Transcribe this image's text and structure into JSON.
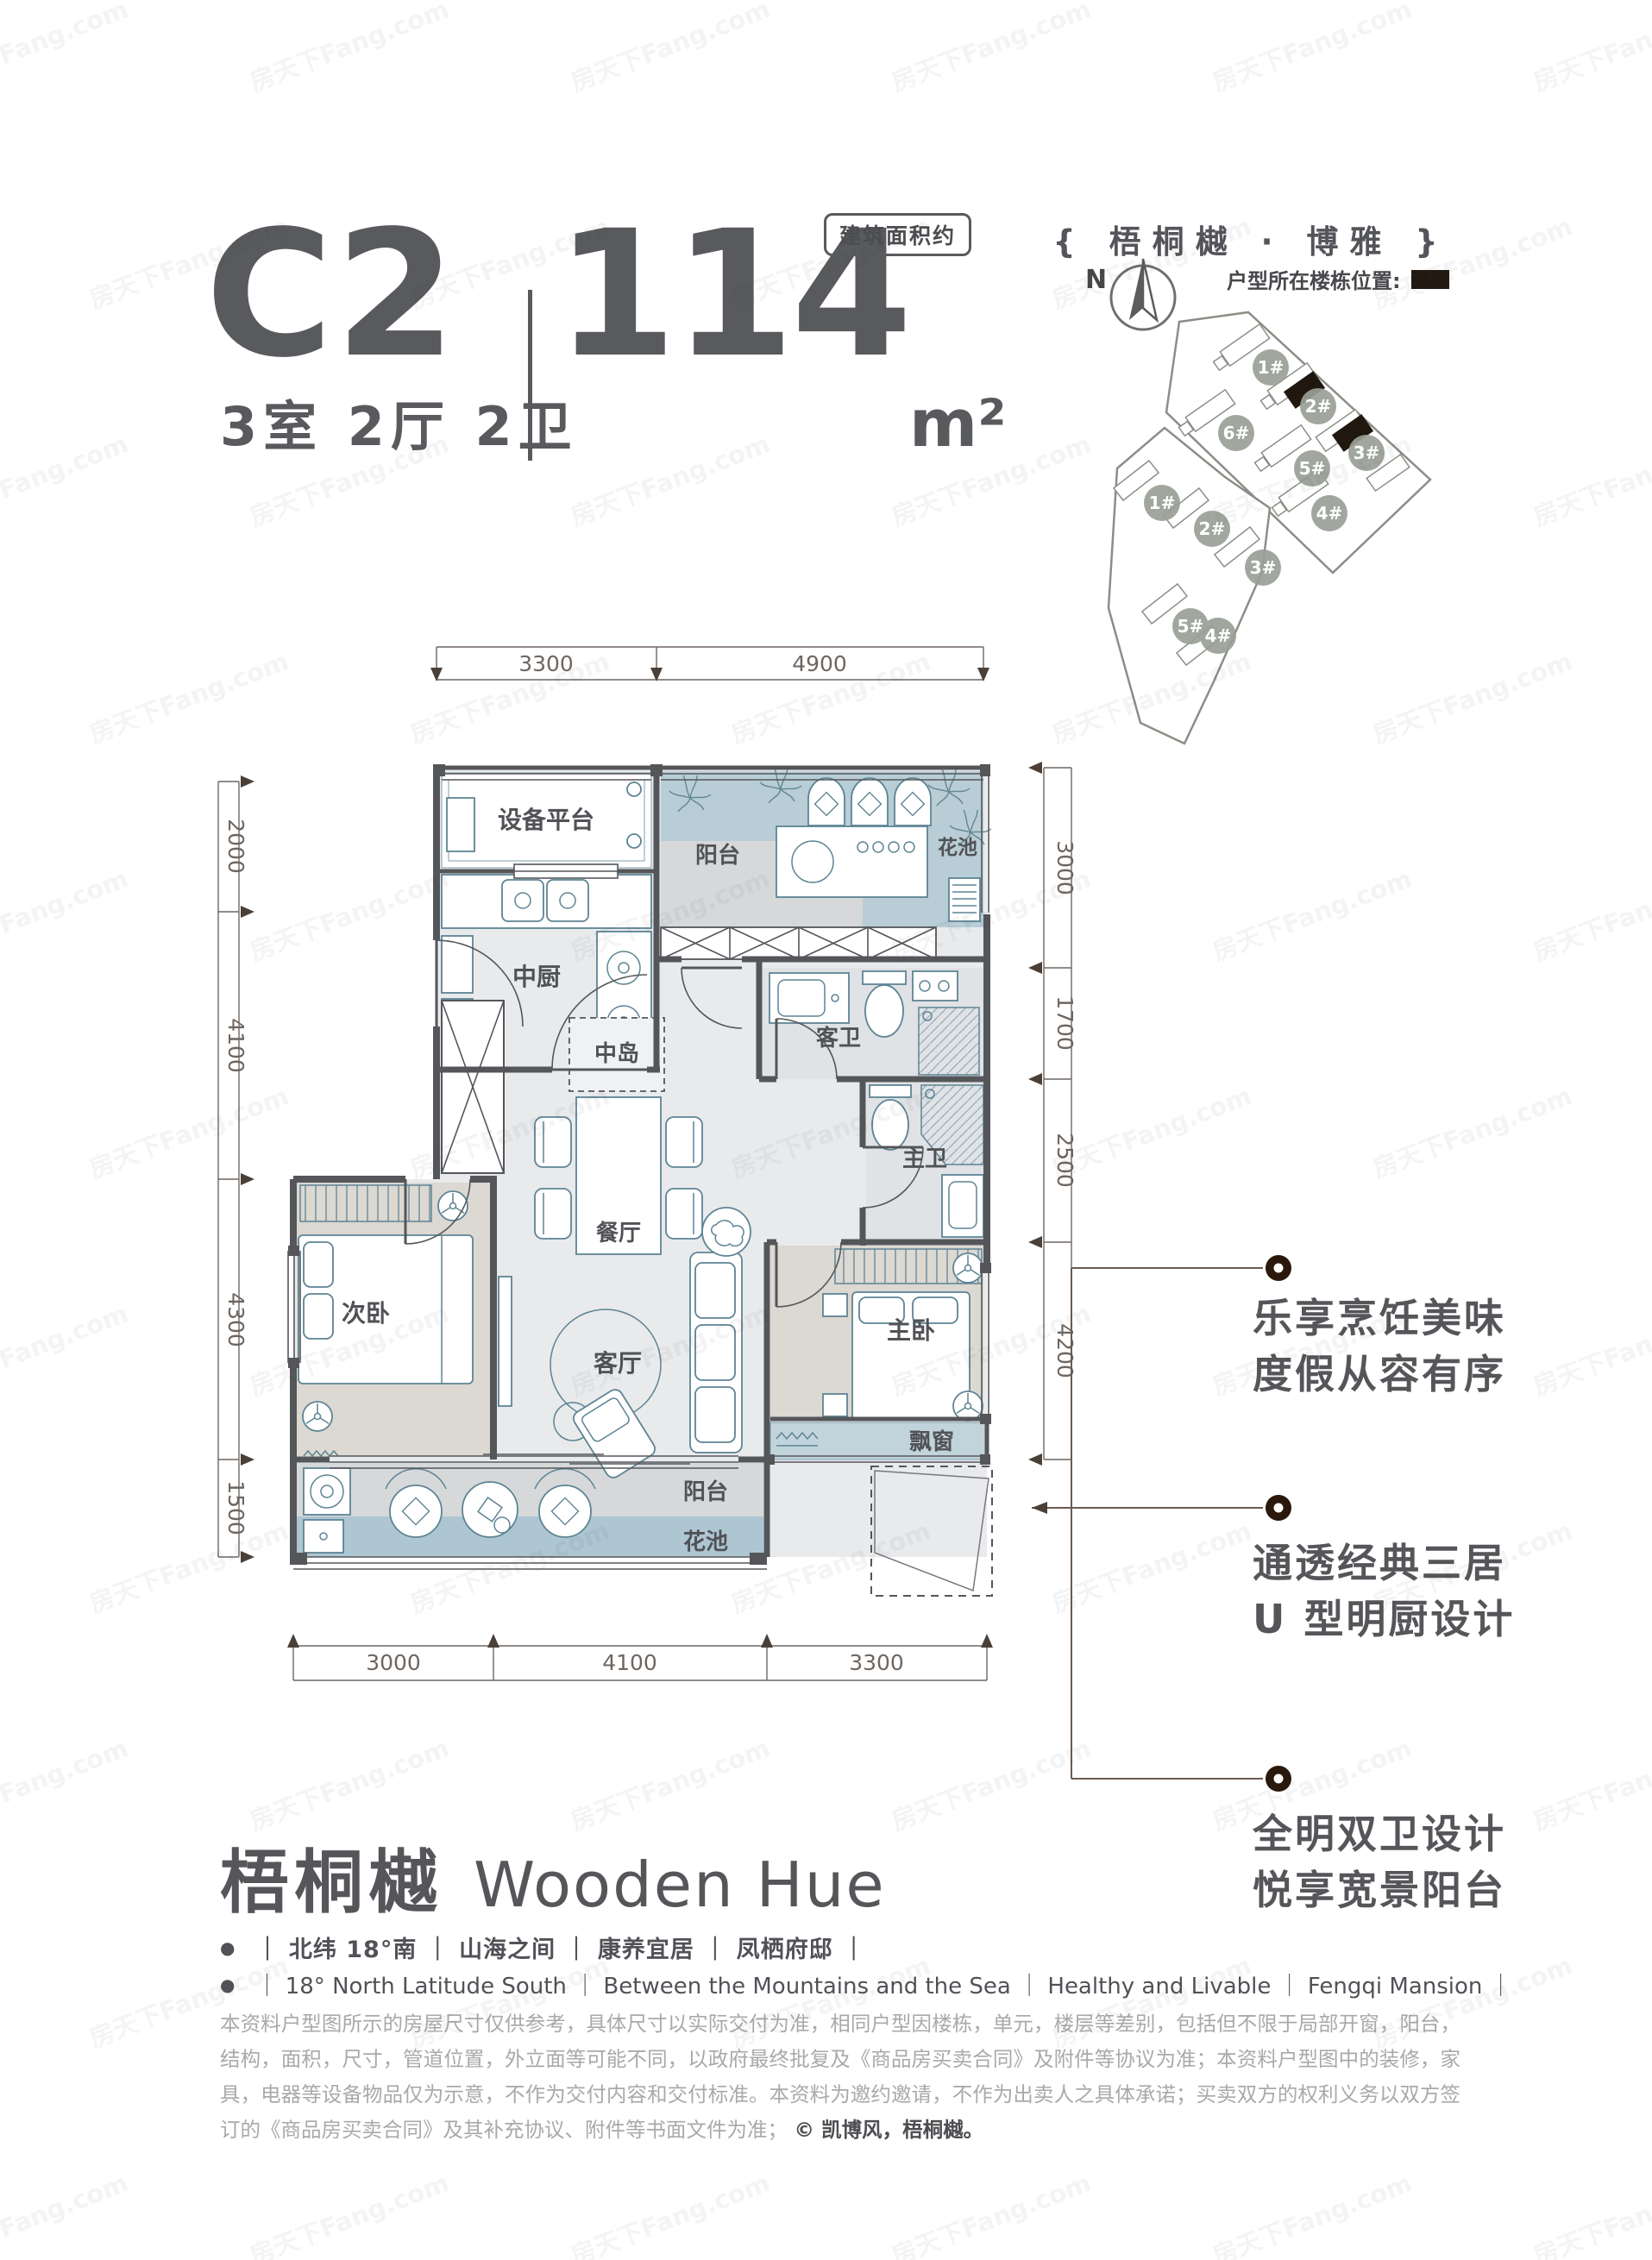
{
  "watermark": {
    "text": "房天下Fang.com"
  },
  "header": {
    "unit": "C2",
    "area": "114",
    "area_unit": "m²",
    "area_note": "建筑面积约",
    "layout": "3室 2厅 2卫"
  },
  "project": {
    "name_banner": "{ 梧桐樾 · 博雅 }",
    "compass": "N",
    "location_label": "户型所在楼栋位置:",
    "site_upper": [
      "1#",
      "2#",
      "6#",
      "5#",
      "3#",
      "4#"
    ],
    "site_lower": [
      "1#",
      "2#",
      "3#",
      "5#",
      "4#"
    ]
  },
  "plan": {
    "rooms": {
      "equipment": "设备平台",
      "kitchen": "中厨",
      "balcony_top": "阳台",
      "flower_top": "花池",
      "island": "中岛",
      "dining": "餐厅",
      "guest_bath": "客卫",
      "master_bath": "主卫",
      "second_bedroom": "次卧",
      "living": "客厅",
      "master_bedroom": "主卧",
      "bay_window": "飘窗",
      "balcony_bottom": "阳台",
      "flower_bottom": "花池"
    },
    "dims_top": [
      "3300",
      "4900"
    ],
    "dims_left": [
      "2000",
      "4100",
      "4300",
      "1500"
    ],
    "dims_right": [
      "3000",
      "1700",
      "2500",
      "4200"
    ],
    "dims_bottom": [
      "3000",
      "4100",
      "3300"
    ]
  },
  "annotations": [
    {
      "line1": "乐享烹饪美味",
      "line2": "度假从容有序"
    },
    {
      "line1": "通透经典三居",
      "line2": "U 型明厨设计"
    },
    {
      "line1": "全明双卫设计",
      "line2": "悦享宽景阳台"
    }
  ],
  "footer": {
    "bullet": "●",
    "logo_cn": "梧桐樾",
    "logo_en": "Wooden Hue",
    "tagline_cn": "｜  北纬 18°南  ｜  山海之间  ｜  康养宜居  ｜  凤栖府邸  ｜",
    "tagline_en": "｜  18° North Latitude South  ｜  Between the Mountains and the Sea  ｜  Healthy and Livable  ｜  Fengqi Mansion  ｜",
    "disclaimer": "本资料户型图所示的房屋尺寸仅供参考，具体尺寸以实际交付为准，相同户型因楼栋，单元，楼层等差别，包括但不限于局部开窗，阳台，结构，面积，尺寸，管道位置，外立面等可能不同，以政府最终批复及《商品房买卖合同》及附件等协议为准；本资料户型图中的装修，家具，电器等设备物品仅为示意，不作为交付内容和交付标准。本资料为邀约邀请，不作为出卖人之具体承诺；买卖双方的权利义务以双方签订的《商品房买卖合同》及其补充协议、附件等书面文件为准；",
    "copyright": "© 凯博风，梧桐樾。"
  }
}
